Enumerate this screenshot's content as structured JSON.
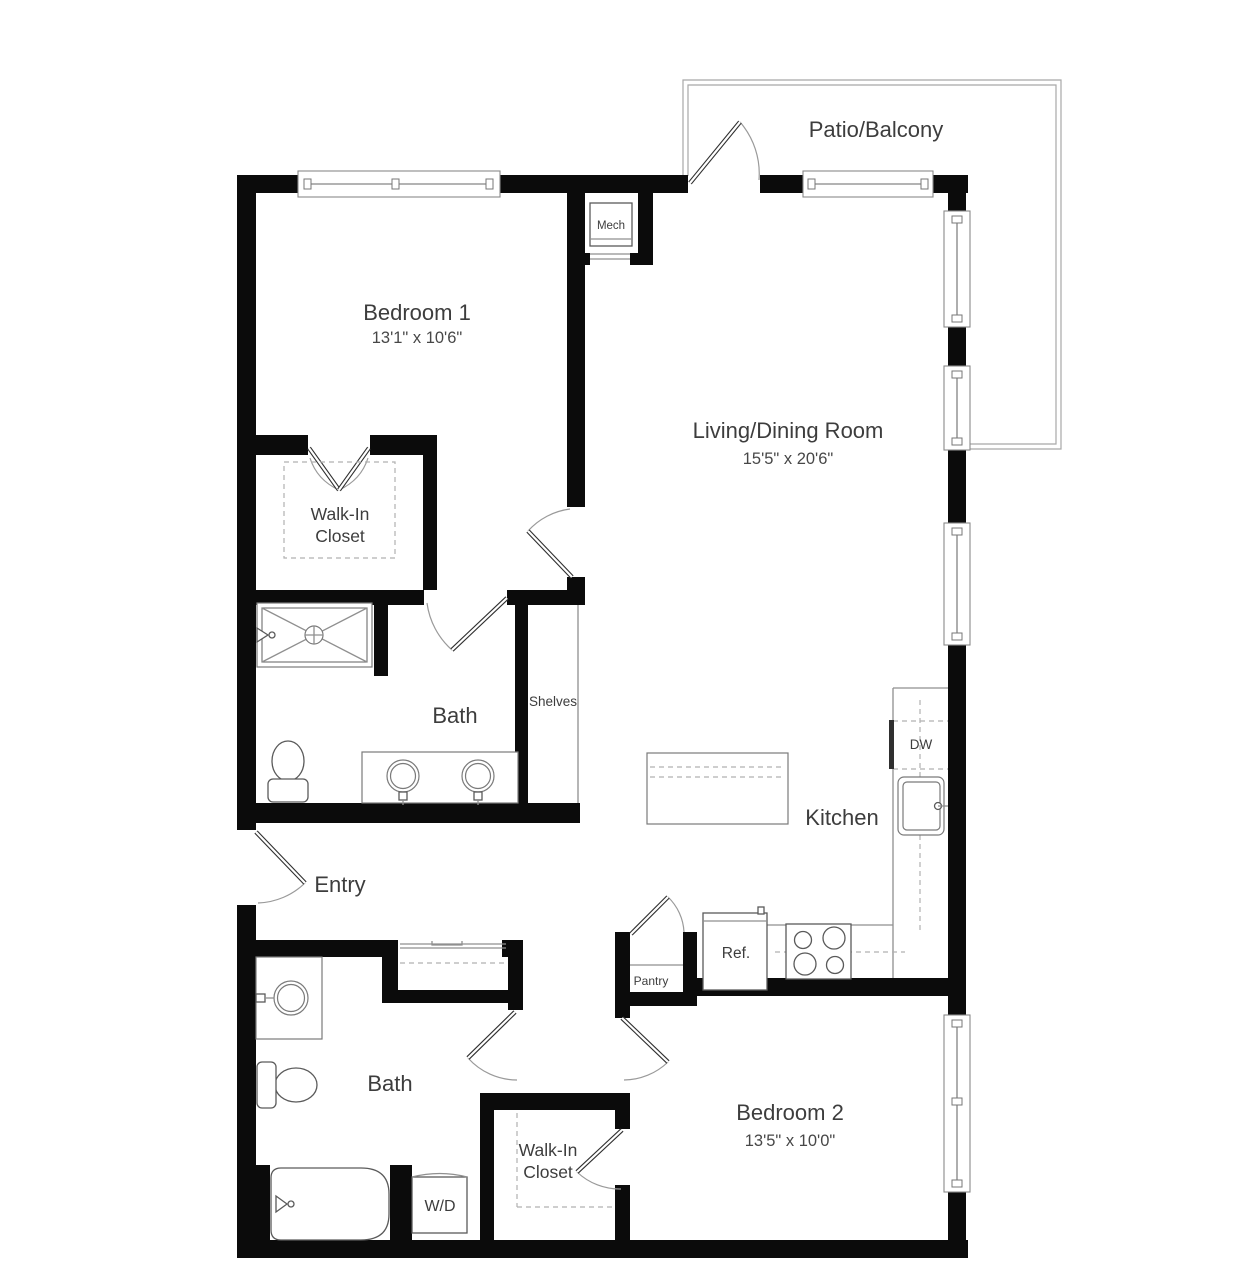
{
  "floor_plan": {
    "rooms": {
      "bedroom1": {
        "name": "Bedroom 1",
        "dimensions": "13'1\" x 10'6\""
      },
      "living_dining": {
        "name": "Living/Dining Room",
        "dimensions": "15'5\" x 20'6\""
      },
      "bedroom2": {
        "name": "Bedroom 2",
        "dimensions": "13'5\" x 10'0\""
      },
      "kitchen": {
        "name": "Kitchen"
      },
      "patio": {
        "name": "Patio/Balcony"
      },
      "entry": {
        "name": "Entry"
      },
      "bath1": {
        "name": "Bath"
      },
      "bath2": {
        "name": "Bath"
      },
      "walk_in_closet1": {
        "name": "Walk-In Closet"
      },
      "walk_in_closet2": {
        "name": "Walk-In Closet"
      },
      "shelves": {
        "name": "Shelves"
      }
    },
    "fixtures": {
      "mech": "Mech",
      "dw": "DW",
      "ref": "Ref.",
      "pantry": "Pantry",
      "wd": "W/D"
    },
    "colors": {
      "wall": "#0b0b0b",
      "line": "#8f8f8f",
      "text": "#3d3d3d",
      "background": "#ffffff"
    }
  }
}
